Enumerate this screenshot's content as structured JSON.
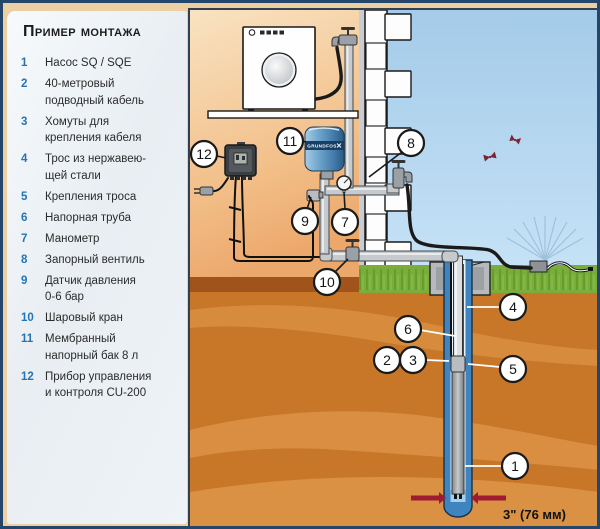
{
  "legend": {
    "title": "Пример монтажа",
    "items": [
      {
        "num": "1",
        "text": "Насос SQ / SQE"
      },
      {
        "num": "2",
        "text": "40-метровый\nподводный кабель"
      },
      {
        "num": "3",
        "text": "Хомуты для\nкрепления кабеля"
      },
      {
        "num": "4",
        "text": "Трос из нержавею-\nщей стали"
      },
      {
        "num": "5",
        "text": "Крепления троса"
      },
      {
        "num": "6",
        "text": "Напорная труба"
      },
      {
        "num": "7",
        "text": "Манометр"
      },
      {
        "num": "8",
        "text": "Запорный вентиль"
      },
      {
        "num": "9",
        "text": "Датчик давления\n0-6 бар"
      },
      {
        "num": "10",
        "text": "Шаровый кран"
      },
      {
        "num": "11",
        "text": "Мембранный\nнапорный бак 8 л"
      },
      {
        "num": "12",
        "text": "Прибор управления\nи контроля CU-200"
      }
    ]
  },
  "diagram": {
    "callouts": {
      "c1": "1",
      "c2": "2",
      "c3": "3",
      "c4": "4",
      "c5": "5",
      "c6": "6",
      "c7": "7",
      "c8": "8",
      "c9": "9",
      "c10": "10",
      "c11": "11",
      "c12": "12"
    },
    "well_diameter_label": "3\" (76 мм)",
    "tank_brand": "GRUNDFOS"
  },
  "colors": {
    "legend_number": "#2573b5",
    "soil": "#c87628",
    "sky": "#a8cfec",
    "indoor": "#f5d4a8",
    "grass": "#77ac3a",
    "tank_blue": "#3f77ac",
    "arrow_red": "#9e1b32",
    "pipe_gray": "#c6cacd"
  }
}
